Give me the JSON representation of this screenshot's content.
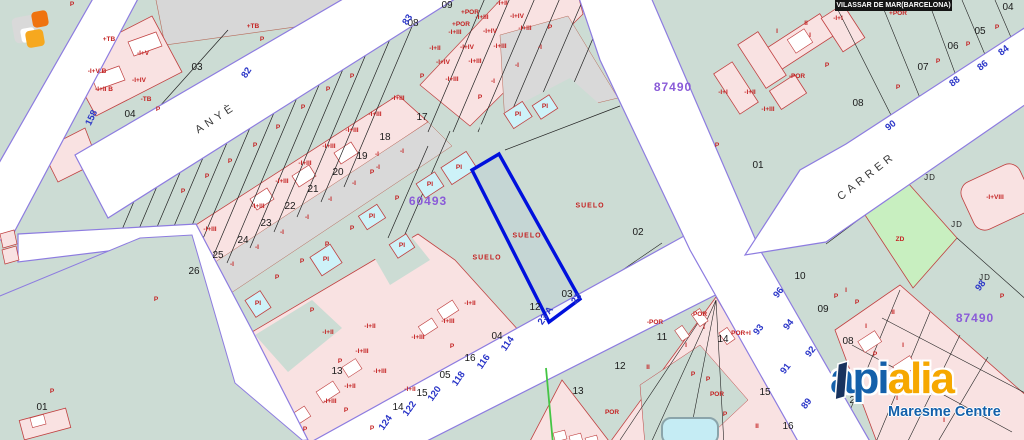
{
  "municipality_bar": {
    "title": "VILASSAR DE MAR(BARCELONA)"
  },
  "watermark": {
    "api": "api",
    "alia": "alia",
    "tagline": "Maresme Centre"
  },
  "colors": {
    "land": "#ccdcd4",
    "parcel_pink": "#f9e2e2",
    "parcel_gray": "#d9d9d9",
    "building_blue": "#cdf2f8",
    "zd_green": "#c8efc0",
    "road_edge": "#8d7ce0",
    "highlight_blue": "#0010dd",
    "label_red": "#c42222",
    "number_blue": "#2b36c8",
    "ref_purple": "#8a5bd8",
    "logo_blue": "#1460aa",
    "logo_orange": "#f6a800"
  },
  "map": {
    "labels": {
      "parcels": [
        {
          "t": "03",
          "x": 197,
          "y": 68
        },
        {
          "t": "04",
          "x": 130,
          "y": 115
        },
        {
          "t": "09",
          "x": 447,
          "y": 6
        },
        {
          "t": "08",
          "x": 413,
          "y": 24
        },
        {
          "t": "17",
          "x": 422,
          "y": 118
        },
        {
          "t": "18",
          "x": 385,
          "y": 138
        },
        {
          "t": "19",
          "x": 362,
          "y": 157
        },
        {
          "t": "20",
          "x": 338,
          "y": 173
        },
        {
          "t": "21",
          "x": 313,
          "y": 190
        },
        {
          "t": "22",
          "x": 290,
          "y": 207
        },
        {
          "t": "23",
          "x": 266,
          "y": 224
        },
        {
          "t": "24",
          "x": 243,
          "y": 241
        },
        {
          "t": "25",
          "x": 218,
          "y": 256
        },
        {
          "t": "26",
          "x": 194,
          "y": 272
        },
        {
          "t": "02",
          "x": 638,
          "y": 233
        },
        {
          "t": "03",
          "x": 567,
          "y": 295
        },
        {
          "t": "12",
          "x": 535,
          "y": 308
        },
        {
          "t": "04",
          "x": 497,
          "y": 337
        },
        {
          "t": "16",
          "x": 470,
          "y": 359
        },
        {
          "t": "05",
          "x": 445,
          "y": 376
        },
        {
          "t": "15",
          "x": 422,
          "y": 394
        },
        {
          "t": "14",
          "x": 398,
          "y": 408
        },
        {
          "t": "13",
          "x": 337,
          "y": 372
        },
        {
          "t": "01",
          "x": 758,
          "y": 166
        },
        {
          "t": "08",
          "x": 858,
          "y": 104
        },
        {
          "t": "04",
          "x": 1008,
          "y": 8
        },
        {
          "t": "05",
          "x": 980,
          "y": 32
        },
        {
          "t": "06",
          "x": 953,
          "y": 47
        },
        {
          "t": "07",
          "x": 923,
          "y": 68
        },
        {
          "t": "10",
          "x": 800,
          "y": 277
        },
        {
          "t": "09",
          "x": 823,
          "y": 310
        },
        {
          "t": "08",
          "x": 848,
          "y": 342
        },
        {
          "t": "11",
          "x": 662,
          "y": 338
        },
        {
          "t": "12",
          "x": 620,
          "y": 367
        },
        {
          "t": "13",
          "x": 578,
          "y": 392
        },
        {
          "t": "14",
          "x": 723,
          "y": 340
        },
        {
          "t": "15",
          "x": 765,
          "y": 393
        },
        {
          "t": "16",
          "x": 788,
          "y": 427
        },
        {
          "t": "01",
          "x": 42,
          "y": 408
        },
        {
          "t": "23",
          "x": 855,
          "y": 401
        }
      ],
      "buildings": [
        {
          "t": "P",
          "x": 72,
          "y": 5
        },
        {
          "t": "+TB",
          "x": 109,
          "y": 40
        },
        {
          "t": "+TB",
          "x": 253,
          "y": 27
        },
        {
          "t": "P",
          "x": 262,
          "y": 40
        },
        {
          "t": "-TB",
          "x": 146,
          "y": 100
        },
        {
          "t": "P",
          "x": 158,
          "y": 110
        },
        {
          "t": "-I+V B",
          "x": 97,
          "y": 72
        },
        {
          "t": "-I+II B",
          "x": 104,
          "y": 90
        },
        {
          "t": "-I+V",
          "x": 143,
          "y": 54
        },
        {
          "t": "-I+IV",
          "x": 139,
          "y": 81
        },
        {
          "t": "P",
          "x": 183,
          "y": 192
        },
        {
          "t": "P",
          "x": 207,
          "y": 177
        },
        {
          "t": "P",
          "x": 230,
          "y": 162
        },
        {
          "t": "P",
          "x": 255,
          "y": 146
        },
        {
          "t": "P",
          "x": 278,
          "y": 128
        },
        {
          "t": "P",
          "x": 303,
          "y": 108
        },
        {
          "t": "P",
          "x": 328,
          "y": 90
        },
        {
          "t": "P",
          "x": 352,
          "y": 77
        },
        {
          "t": "-I+III",
          "x": 210,
          "y": 230
        },
        {
          "t": "-I+III",
          "x": 258,
          "y": 207
        },
        {
          "t": "-I+III",
          "x": 282,
          "y": 182
        },
        {
          "t": "-I+III",
          "x": 305,
          "y": 164
        },
        {
          "t": "-I+III",
          "x": 329,
          "y": 147
        },
        {
          "t": "-I+III",
          "x": 352,
          "y": 131
        },
        {
          "t": "-I+III",
          "x": 375,
          "y": 115
        },
        {
          "t": "-I+III",
          "x": 398,
          "y": 99
        },
        {
          "t": "-I",
          "x": 232,
          "y": 265
        },
        {
          "t": "-I",
          "x": 257,
          "y": 248
        },
        {
          "t": "-I",
          "x": 282,
          "y": 233
        },
        {
          "t": "-I",
          "x": 307,
          "y": 218
        },
        {
          "t": "-I",
          "x": 330,
          "y": 200
        },
        {
          "t": "-I",
          "x": 354,
          "y": 184
        },
        {
          "t": "-I",
          "x": 378,
          "y": 168
        },
        {
          "t": "-I",
          "x": 402,
          "y": 152
        },
        {
          "t": "P",
          "x": 277,
          "y": 278
        },
        {
          "t": "P",
          "x": 302,
          "y": 262
        },
        {
          "t": "P",
          "x": 327,
          "y": 245
        },
        {
          "t": "P",
          "x": 352,
          "y": 229
        },
        {
          "t": "P",
          "x": 372,
          "y": 173
        },
        {
          "t": "P",
          "x": 397,
          "y": 199
        },
        {
          "t": "-I",
          "x": 377,
          "y": 155
        },
        {
          "t": "+POR",
          "x": 470,
          "y": 13
        },
        {
          "t": "+POR",
          "x": 461,
          "y": 25
        },
        {
          "t": "-I+II",
          "x": 502,
          "y": 4
        },
        {
          "t": "-I+III",
          "x": 482,
          "y": 18
        },
        {
          "t": "-I+IV",
          "x": 517,
          "y": 17
        },
        {
          "t": "-I+III",
          "x": 455,
          "y": 33
        },
        {
          "t": "-I+IV",
          "x": 490,
          "y": 32
        },
        {
          "t": "-I+III",
          "x": 525,
          "y": 29
        },
        {
          "t": "-I+II",
          "x": 435,
          "y": 49
        },
        {
          "t": "-I+IV",
          "x": 467,
          "y": 48
        },
        {
          "t": "-I+III",
          "x": 500,
          "y": 47
        },
        {
          "t": "-I",
          "x": 540,
          "y": 48
        },
        {
          "t": "-I+IV",
          "x": 443,
          "y": 63
        },
        {
          "t": "-I+III",
          "x": 475,
          "y": 62
        },
        {
          "t": "-I",
          "x": 517,
          "y": 66
        },
        {
          "t": "-I+III",
          "x": 452,
          "y": 80
        },
        {
          "t": "-I",
          "x": 493,
          "y": 82
        },
        {
          "t": "P",
          "x": 550,
          "y": 28
        },
        {
          "t": "P",
          "x": 422,
          "y": 77
        },
        {
          "t": "P",
          "x": 480,
          "y": 98
        },
        {
          "t": "PI",
          "x": 372,
          "y": 217
        },
        {
          "t": "PI",
          "x": 402,
          "y": 246
        },
        {
          "t": "PI",
          "x": 430,
          "y": 185
        },
        {
          "t": "PI",
          "x": 459,
          "y": 168
        },
        {
          "t": "PI",
          "x": 518,
          "y": 115
        },
        {
          "t": "PI",
          "x": 545,
          "y": 107
        },
        {
          "t": "PI",
          "x": 326,
          "y": 260
        },
        {
          "t": "PI",
          "x": 258,
          "y": 304
        },
        {
          "t": "-I+II",
          "x": 328,
          "y": 333
        },
        {
          "t": "-I+III",
          "x": 362,
          "y": 352
        },
        {
          "t": "-I+III",
          "x": 418,
          "y": 338
        },
        {
          "t": "-I+III",
          "x": 380,
          "y": 372
        },
        {
          "t": "-I+II",
          "x": 410,
          "y": 390
        },
        {
          "t": "-I+II",
          "x": 350,
          "y": 387
        },
        {
          "t": "-I+III",
          "x": 330,
          "y": 402
        },
        {
          "t": "P",
          "x": 312,
          "y": 311
        },
        {
          "t": "P",
          "x": 346,
          "y": 411
        },
        {
          "t": "P",
          "x": 372,
          "y": 429
        },
        {
          "t": "P",
          "x": 305,
          "y": 430
        },
        {
          "t": "-I+II",
          "x": 470,
          "y": 304
        },
        {
          "t": "-I+III",
          "x": 448,
          "y": 322
        },
        {
          "t": "-I+II",
          "x": 370,
          "y": 327
        },
        {
          "t": "P",
          "x": 340,
          "y": 362
        },
        {
          "t": "P",
          "x": 452,
          "y": 347
        },
        {
          "t": "-POR",
          "x": 655,
          "y": 323
        },
        {
          "t": "POR",
          "x": 700,
          "y": 315
        },
        {
          "t": "I",
          "x": 704,
          "y": 328
        },
        {
          "t": "POR+I",
          "x": 741,
          "y": 334
        },
        {
          "t": "I",
          "x": 686,
          "y": 346
        },
        {
          "t": "II",
          "x": 648,
          "y": 368
        },
        {
          "t": "P",
          "x": 693,
          "y": 375
        },
        {
          "t": "P",
          "x": 708,
          "y": 380
        },
        {
          "t": "POR",
          "x": 717,
          "y": 395
        },
        {
          "t": "P",
          "x": 725,
          "y": 415
        },
        {
          "t": "II",
          "x": 757,
          "y": 427
        },
        {
          "t": "POR",
          "x": 612,
          "y": 413
        },
        {
          "t": "I",
          "x": 777,
          "y": 32
        },
        {
          "t": "II",
          "x": 806,
          "y": 24
        },
        {
          "t": "I",
          "x": 810,
          "y": 36
        },
        {
          "t": "-I+I",
          "x": 838,
          "y": 19
        },
        {
          "t": "-POR",
          "x": 797,
          "y": 77
        },
        {
          "t": "P",
          "x": 827,
          "y": 66
        },
        {
          "t": "-I+I",
          "x": 723,
          "y": 93
        },
        {
          "t": "-I+II",
          "x": 750,
          "y": 93
        },
        {
          "t": "-I+III",
          "x": 768,
          "y": 110
        },
        {
          "t": "P",
          "x": 997,
          "y": 28
        },
        {
          "t": "P",
          "x": 968,
          "y": 45
        },
        {
          "t": "P",
          "x": 938,
          "y": 62
        },
        {
          "t": "P",
          "x": 898,
          "y": 88
        },
        {
          "t": "+POR",
          "x": 898,
          "y": 14
        },
        {
          "t": "P",
          "x": 717,
          "y": 146
        },
        {
          "t": "ZD",
          "x": 900,
          "y": 240
        },
        {
          "t": "-I+VIII",
          "x": 995,
          "y": 198
        },
        {
          "t": "P",
          "x": 1002,
          "y": 297
        },
        {
          "t": "P",
          "x": 836,
          "y": 297
        },
        {
          "t": "I",
          "x": 846,
          "y": 291
        },
        {
          "t": "P",
          "x": 857,
          "y": 303
        },
        {
          "t": "II",
          "x": 893,
          "y": 313
        },
        {
          "t": "I",
          "x": 866,
          "y": 327
        },
        {
          "t": "P",
          "x": 875,
          "y": 355
        },
        {
          "t": "I",
          "x": 903,
          "y": 346
        },
        {
          "t": "II",
          "x": 920,
          "y": 390
        },
        {
          "t": "I",
          "x": 897,
          "y": 399
        },
        {
          "t": "I",
          "x": 944,
          "y": 421
        },
        {
          "t": "P",
          "x": 156,
          "y": 300
        },
        {
          "t": "P",
          "x": 52,
          "y": 392
        }
      ],
      "streets": [
        {
          "t": "158",
          "x": 92,
          "y": 118,
          "r": -64
        },
        {
          "t": "82",
          "x": 247,
          "y": 73,
          "r": -57
        },
        {
          "t": "83",
          "x": 408,
          "y": 20,
          "r": -57
        },
        {
          "t": "84",
          "x": 1004,
          "y": 51,
          "r": -38
        },
        {
          "t": "86",
          "x": 983,
          "y": 66,
          "r": -38
        },
        {
          "t": "88",
          "x": 955,
          "y": 82,
          "r": -38
        },
        {
          "t": "90",
          "x": 891,
          "y": 126,
          "r": -38
        },
        {
          "t": "96",
          "x": 779,
          "y": 293,
          "r": -52
        },
        {
          "t": "94",
          "x": 789,
          "y": 325,
          "r": -52
        },
        {
          "t": "93",
          "x": 759,
          "y": 330,
          "r": -52
        },
        {
          "t": "92",
          "x": 811,
          "y": 352,
          "r": -52
        },
        {
          "t": "91",
          "x": 786,
          "y": 369,
          "r": -52
        },
        {
          "t": "89",
          "x": 807,
          "y": 404,
          "r": -52
        },
        {
          "t": "98",
          "x": 981,
          "y": 286,
          "r": -52
        },
        {
          "t": "114",
          "x": 508,
          "y": 344,
          "r": -55
        },
        {
          "t": "116",
          "x": 484,
          "y": 362,
          "r": -55
        },
        {
          "t": "118",
          "x": 459,
          "y": 379,
          "r": -55
        },
        {
          "t": "120",
          "x": 435,
          "y": 394,
          "r": -55
        },
        {
          "t": "122",
          "x": 410,
          "y": 409,
          "r": -55
        },
        {
          "t": "124",
          "x": 386,
          "y": 423,
          "r": -55
        },
        {
          "t": "23 A",
          "x": 546,
          "y": 316,
          "r": -55
        },
        {
          "t": "23",
          "x": 577,
          "y": 299,
          "r": -55
        }
      ],
      "refs": [
        {
          "t": "87490",
          "x": 673,
          "y": 87
        },
        {
          "t": "87490",
          "x": 975,
          "y": 318
        },
        {
          "t": "60493",
          "x": 428,
          "y": 201
        }
      ],
      "names": [
        {
          "t": "ANYÈ",
          "x": 216,
          "y": 119,
          "r": -33
        },
        {
          "t": "CARRER",
          "x": 867,
          "y": 177,
          "r": -38
        }
      ],
      "suelo": [
        {
          "t": "SUELO",
          "x": 487,
          "y": 258
        },
        {
          "t": "SUELO",
          "x": 527,
          "y": 236
        },
        {
          "t": "SUELO",
          "x": 590,
          "y": 206
        }
      ],
      "jd": [
        {
          "t": "JD",
          "x": 930,
          "y": 178
        },
        {
          "t": "JD",
          "x": 957,
          "y": 225
        },
        {
          "t": "JD",
          "x": 985,
          "y": 278
        }
      ]
    }
  }
}
